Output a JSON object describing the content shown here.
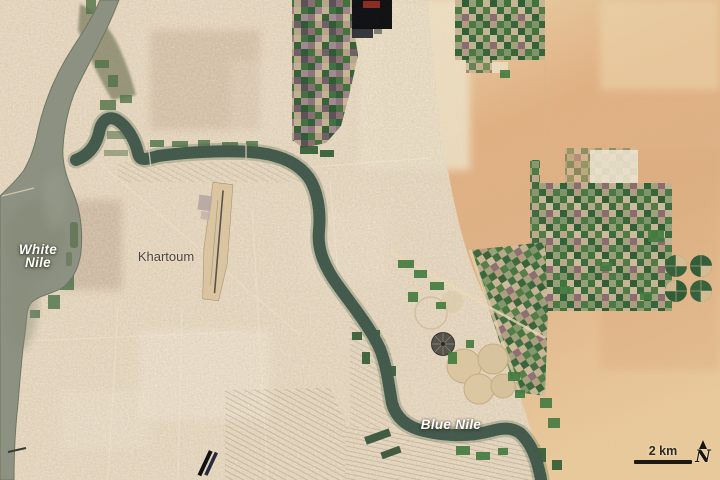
{
  "labels": {
    "white_nile_line1": "White",
    "white_nile_line2": "Nile",
    "khartoum": "Khartoum",
    "blue_nile": "Blue Nile"
  },
  "scale_bar": {
    "label": "2 km"
  },
  "compass": {
    "label": "N",
    "icon": "north-arrow-icon"
  },
  "colors": {
    "urban": "#e9d9c0",
    "desert": "#e2b88c",
    "river_wide": "#8c9181",
    "river_dark": "#41594b",
    "vegetation": "#3f7a3d",
    "label_white": "#ffffff",
    "label_gray": "#4b4741"
  }
}
